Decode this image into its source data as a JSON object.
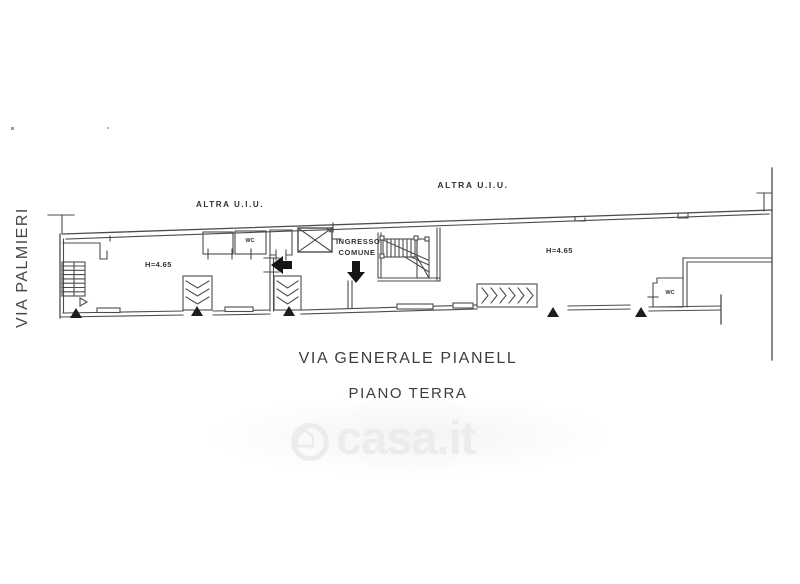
{
  "plan": {
    "street_left": "VIA PALMIERI",
    "street_bottom": "VIA GENERALE PIANELL",
    "floor_label": "PIANO TERRA",
    "unit_label_left": "ALTRA U.I.U.",
    "unit_label_right": "ALTRA U.I.U.",
    "height_label_left": "H=4.65",
    "height_label_right": "H=4.65",
    "wc_label_left": "WC",
    "wc_label_right": "WC",
    "entrance_label_line1": "INGRESSO",
    "entrance_label_line2": "COMUNE",
    "line_color": "#4c4c4c"
  },
  "watermark": {
    "text": "casa.it",
    "icon": "house-in-circle",
    "color": "#ececec"
  }
}
